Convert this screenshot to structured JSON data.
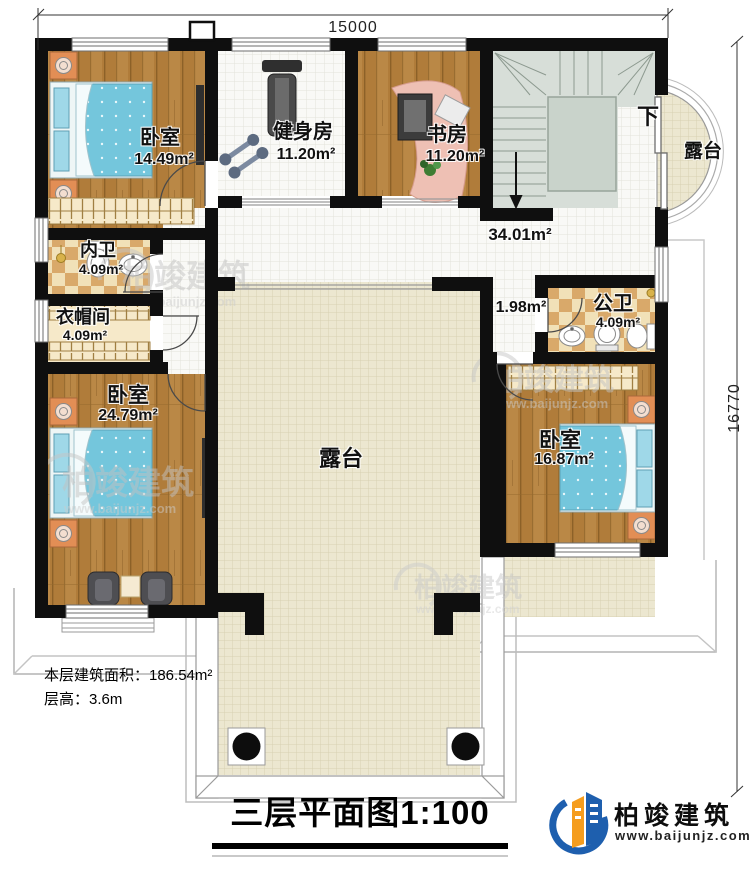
{
  "dimensions": {
    "top": "15000",
    "right": "16770"
  },
  "rooms": {
    "bedroom1": {
      "name": "卧室",
      "area": "14.49m²"
    },
    "gym": {
      "name": "健身房",
      "area": "11.20m²"
    },
    "study": {
      "name": "书房",
      "area": "11.20m²"
    },
    "terrace_right": {
      "name": "露台"
    },
    "terrace_center": {
      "name": "露台"
    },
    "stairs": {
      "down_label": "下"
    },
    "hall": {
      "area": "34.01m²"
    },
    "nook": {
      "area": "1.98m²"
    },
    "inner_bath": {
      "name": "内卫",
      "area": "4.09m²"
    },
    "closet": {
      "name": "衣帽间",
      "area": "4.09m²"
    },
    "public_bath": {
      "name": "公卫",
      "area": "4.09m²"
    },
    "bedroom2": {
      "name": "卧室",
      "area": "24.79m²"
    },
    "bedroom3": {
      "name": "卧室",
      "area": "16.87m²"
    }
  },
  "annotations": {
    "floor_area": "本层建筑面积：186.54m²",
    "floor_height": "层高：3.6m"
  },
  "title_block": {
    "title": "三层平面图1:100"
  },
  "branding": {
    "company": "柏竣建筑",
    "website": "www.baijunjz.com"
  },
  "watermark": {
    "name": "柏竣建筑",
    "url": "www.baijunjz.com"
  },
  "colors": {
    "wall": "#0f0f0f",
    "wood": "#b07c3a",
    "tile_white": "#f9f9f6",
    "tile_beige": "#ece7d0",
    "checker_dark": "#d9a96a",
    "checker_light": "#f1e1b8",
    "stairs": "#d7ded8",
    "bed_blue": "#74c6dc",
    "nightstand": "#e28e55",
    "logo_blue": "#1e5fae",
    "logo_orange": "#f59d1e"
  }
}
